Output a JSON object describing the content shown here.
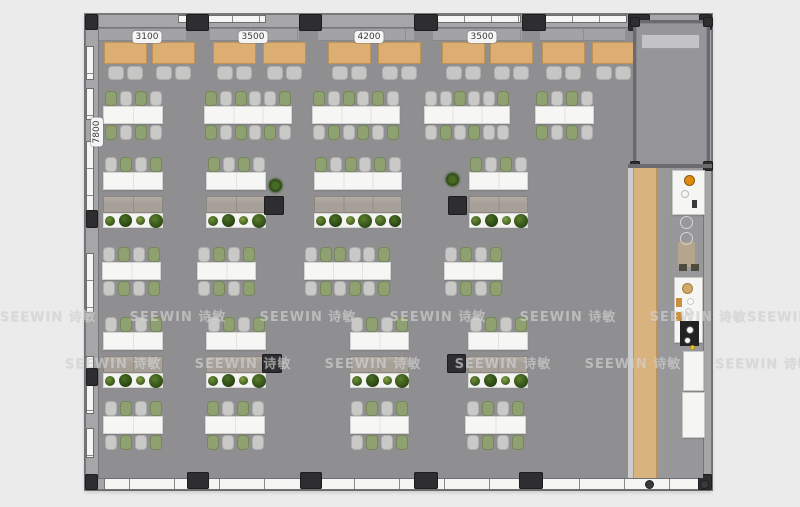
{
  "canvas": {
    "w": 800,
    "h": 507,
    "bg": "#ebebeb"
  },
  "watermark": {
    "text": "SEEWIN 诗敏",
    "rows": [
      {
        "y": 306,
        "xs": [
          48,
          178,
          308,
          438,
          568,
          698,
          795
        ]
      },
      {
        "y": 353,
        "xs": [
          113,
          243,
          373,
          503,
          633,
          763
        ]
      }
    ]
  },
  "labels": {
    "top_y": 17,
    "top": [
      {
        "text": "3100",
        "x": 62
      },
      {
        "text": "3500",
        "x": 168
      },
      {
        "text": "4200",
        "x": 284
      },
      {
        "text": "3500",
        "x": 397
      }
    ],
    "left": {
      "text": "7800",
      "x": 12,
      "y": 98
    }
  },
  "plan": {
    "x": 85,
    "y": 14,
    "w": 627,
    "h": 476,
    "colors": {
      "floor": "#8f8f91",
      "wall": "#a6a6a8",
      "pillar": "#2e2e30",
      "bench": "#a3a3a5",
      "booth_table": "#dcae72",
      "booth_chair": "#c6c6c4",
      "desk": "#f6f6f4",
      "chair_green": "#8fa170",
      "chair_silver": "#c9c9c7",
      "chair_green_border": "#76875a",
      "chair_silver_border": "#aeaeac",
      "cabinet": "#a7a099",
      "planter": "#f4f4f2",
      "wood": "#d9b37e",
      "room_floor": "#96969a",
      "credenza": "#c4c4c6",
      "kitchen_floor": "#98989b",
      "corridor_light": "#cdcdcf"
    },
    "walls": [
      {
        "side": "top",
        "x": 0,
        "y": 0,
        "w": 627,
        "h": 14
      },
      {
        "side": "left",
        "x": 0,
        "y": 0,
        "w": 14,
        "h": 476
      },
      {
        "side": "right",
        "x": 618,
        "y": 0,
        "w": 9,
        "h": 476
      }
    ],
    "bottom_band": {
      "x": 0,
      "y": 464,
      "w": 627,
      "h": 12
    },
    "bottom_cap": {
      "x": 0,
      "y": 464,
      "w": 20,
      "h": 12
    },
    "windows_top": [
      {
        "x": 93,
        "w": 88
      },
      {
        "x": 352,
        "w": 84
      },
      {
        "x": 460,
        "w": 82
      }
    ],
    "windows_left": [
      {
        "y": 32,
        "h": 34
      },
      {
        "y": 74,
        "h": 32
      },
      {
        "y": 127,
        "h": 72
      },
      {
        "y": 239,
        "h": 60
      },
      {
        "y": 342,
        "h": 58
      },
      {
        "y": 414,
        "h": 30
      }
    ],
    "pillars": [
      {
        "x": 101,
        "y": 0,
        "w": 23,
        "h": 17
      },
      {
        "x": 214,
        "y": 0,
        "w": 23,
        "h": 17
      },
      {
        "x": 329,
        "y": 0,
        "w": 24,
        "h": 17
      },
      {
        "x": 437,
        "y": 0,
        "w": 24,
        "h": 17
      },
      {
        "x": 543,
        "y": 0,
        "w": 22,
        "h": 17
      },
      {
        "x": 0,
        "y": 0,
        "w": 13,
        "h": 16
      },
      {
        "x": 614,
        "y": 0,
        "w": 13,
        "h": 16
      },
      {
        "x": 1,
        "y": 196,
        "w": 12,
        "h": 18
      },
      {
        "x": 1,
        "y": 354,
        "w": 12,
        "h": 18
      },
      {
        "x": 179,
        "y": 182,
        "w": 20,
        "h": 19
      },
      {
        "x": 363,
        "y": 182,
        "w": 19,
        "h": 19
      },
      {
        "x": 177,
        "y": 340,
        "w": 20,
        "h": 19
      },
      {
        "x": 362,
        "y": 340,
        "w": 19,
        "h": 19
      },
      {
        "x": 102,
        "y": 458,
        "w": 22,
        "h": 17
      },
      {
        "x": 215,
        "y": 458,
        "w": 22,
        "h": 17
      },
      {
        "x": 329,
        "y": 458,
        "w": 24,
        "h": 17
      },
      {
        "x": 434,
        "y": 458,
        "w": 24,
        "h": 17
      },
      {
        "x": 0,
        "y": 460,
        "w": 13,
        "h": 16
      },
      {
        "x": 613,
        "y": 460,
        "w": 14,
        "h": 16
      }
    ],
    "bench_y": 14,
    "bench_h": 13,
    "benches": [
      {
        "x": 14,
        "w": 87
      },
      {
        "x": 125,
        "w": 89
      },
      {
        "x": 233,
        "w": 96
      },
      {
        "x": 348,
        "w": 89
      },
      {
        "x": 455,
        "w": 85
      }
    ],
    "booth_tables": {
      "y": 28,
      "w": 43,
      "h": 22,
      "chair_y": 52,
      "xs": [
        19,
        67,
        128,
        178,
        243,
        293,
        357,
        405,
        457,
        507
      ]
    },
    "desk_h": 18,
    "chair_h": 15,
    "cab_h": 17,
    "planter_h": 15,
    "desk_rows": [
      {
        "chairs_top": 77,
        "desk": 92,
        "chairs_bottom": 111,
        "clusters": [
          {
            "x": 18,
            "w": 60,
            "segs": 2,
            "top": "gsgs",
            "bottom": "gsgs"
          },
          {
            "x": 119,
            "w": 88,
            "segs": 3,
            "top": "gsgssg",
            "bottom": "gsgsgs"
          },
          {
            "x": 227,
            "w": 88,
            "segs": 3,
            "top": "gsgsgs",
            "bottom": "sgsgsg"
          },
          {
            "x": 339,
            "w": 86,
            "segs": 3,
            "top": "ssgssg",
            "bottom": "sgsgss"
          },
          {
            "x": 450,
            "w": 59,
            "segs": 2,
            "top": "gsgs",
            "bottom": "gsgs"
          }
        ]
      },
      {
        "chairs_top": 143,
        "desk": 158,
        "cabinet": 182,
        "planter": 199,
        "clusters": [
          {
            "x": 18,
            "w": 60,
            "segs": 2,
            "top": "sgsg",
            "plants": 4
          },
          {
            "x": 121,
            "w": 60,
            "segs": 2,
            "top": "gsgs",
            "plants": 4
          },
          {
            "x": 229,
            "w": 88,
            "segs": 3,
            "top": "gsgsgs",
            "plants": 6
          },
          {
            "x": 384,
            "w": 59,
            "segs": 2,
            "top": "gsgs",
            "plants": 4
          }
        ]
      },
      {
        "chairs_top": 233,
        "desk": 248,
        "chairs_bottom": 267,
        "clusters": [
          {
            "x": 17,
            "w": 59,
            "segs": 2,
            "top": "sgsg",
            "bottom": "sgsg"
          },
          {
            "x": 112,
            "w": 59,
            "segs": 2,
            "top": "sgsg",
            "bottom": "sgsg"
          },
          {
            "x": 219,
            "w": 87,
            "segs": 3,
            "top": "sggssg",
            "bottom": "sgsgsg"
          },
          {
            "x": 359,
            "w": 59,
            "segs": 2,
            "top": "sgsg",
            "bottom": "sgsg"
          }
        ]
      },
      {
        "chairs_top": 303,
        "desk": 318,
        "cabinet": 342,
        "planter": 359,
        "clusters": [
          {
            "x": 18,
            "w": 60,
            "segs": 2,
            "top": "sgsg",
            "plants": 4
          },
          {
            "x": 121,
            "w": 60,
            "segs": 2,
            "top": "sgsg",
            "plants": 4
          },
          {
            "x": 265,
            "w": 59,
            "segs": 2,
            "top": "sgsg",
            "plants": 4
          },
          {
            "x": 383,
            "w": 60,
            "segs": 2,
            "top": "sgsg",
            "plants": 4
          }
        ]
      },
      {
        "chairs_top": 387,
        "desk": 402,
        "chairs_bottom": 421,
        "clusters": [
          {
            "x": 18,
            "w": 60,
            "segs": 2,
            "top": "sgsg",
            "bottom": "sgsg"
          },
          {
            "x": 120,
            "w": 60,
            "segs": 2,
            "top": "gsgs",
            "bottom": "gsgs"
          },
          {
            "x": 265,
            "w": 59,
            "segs": 2,
            "top": "sgsg",
            "bottom": "sgsg"
          },
          {
            "x": 380,
            "w": 61,
            "segs": 2,
            "top": "sgsg",
            "bottom": "sgsg"
          }
        ]
      }
    ],
    "plant_palette": [
      [
        "#6f8f38",
        "#33511a"
      ],
      [
        "#4c7026",
        "#243f10"
      ],
      [
        "#86a347",
        "#3c5a1e"
      ],
      [
        "#5a7e2c",
        "#2b4814"
      ]
    ],
    "plant_sizes": [
      10,
      13,
      9,
      14,
      11,
      12
    ],
    "floor_plants": [
      {
        "x": 181,
        "y": 162,
        "s": 19
      },
      {
        "x": 358,
        "y": 156,
        "s": 19
      }
    ],
    "meeting_room": {
      "x": 548,
      "y": 6,
      "w": 77,
      "h": 148,
      "credenza": {
        "x": 8,
        "y": 14,
        "w": 59,
        "h": 15
      }
    },
    "corridor": {
      "divider": {
        "x": 543,
        "y": 150,
        "w": 84,
        "h": 4
      },
      "light": {
        "x": 543,
        "y": 154,
        "w": 5,
        "h": 310
      },
      "wood": {
        "x": 548,
        "y": 154,
        "w": 24,
        "h": 310
      },
      "kitchen_floor": {
        "x": 572,
        "y": 154,
        "w": 46,
        "h": 310
      }
    },
    "kitchen": {
      "panels": [
        {
          "x": 587,
          "y": 156,
          "w": 33,
          "h": 45
        },
        {
          "x": 589,
          "y": 263,
          "w": 29,
          "h": 66
        },
        {
          "x": 598,
          "y": 337,
          "w": 21,
          "h": 40
        },
        {
          "x": 597,
          "y": 378,
          "w": 23,
          "h": 46
        }
      ],
      "rects": [
        {
          "x": 595,
          "y": 307,
          "w": 19,
          "h": 25,
          "c": "#222224"
        },
        {
          "x": 591,
          "y": 284,
          "w": 6,
          "h": 9,
          "c": "#c9913f"
        },
        {
          "x": 591,
          "y": 298,
          "w": 6,
          "h": 9,
          "c": "#c9913f"
        },
        {
          "x": 593,
          "y": 228,
          "w": 17,
          "h": 25,
          "c": "#b4a68c"
        },
        {
          "x": 607,
          "y": 186,
          "w": 5,
          "h": 8,
          "c": "#3a3a3c"
        },
        {
          "x": 594,
          "y": 250,
          "w": 8,
          "h": 7,
          "c": "#4c4c3e"
        },
        {
          "x": 606,
          "y": 250,
          "w": 8,
          "h": 7,
          "c": "#4c4c3e"
        }
      ],
      "circles": [
        {
          "x": 599,
          "y": 161,
          "d": 11,
          "c": "#e08a12",
          "b": "#8a5a0a"
        },
        {
          "x": 596,
          "y": 176,
          "d": 8,
          "c": "transparent",
          "b": "#b9b9b7"
        },
        {
          "x": 597,
          "y": 269,
          "d": 11,
          "c": "#d2a968",
          "b": "#a37c3f"
        },
        {
          "x": 602,
          "y": 284,
          "d": 7,
          "c": "#fafafa",
          "b": "#c9c9c9"
        },
        {
          "x": 600,
          "y": 294,
          "d": 7,
          "c": "#f0f0ee",
          "b": "#c9c9c9"
        },
        {
          "x": 601,
          "y": 312,
          "d": 8,
          "c": "#fafafa",
          "b": "#555557"
        },
        {
          "x": 599,
          "y": 323,
          "d": 7,
          "c": "#fafafa",
          "b": "#555557"
        },
        {
          "x": 605,
          "y": 331,
          "d": 5,
          "c": "#e6c43c",
          "b": "#b99112"
        },
        {
          "x": 595,
          "y": 202,
          "d": 13,
          "c": "transparent",
          "b": "#d5d5d3"
        },
        {
          "x": 595,
          "y": 218,
          "d": 13,
          "c": "transparent",
          "b": "#d5d5d3"
        },
        {
          "x": 560,
          "y": 466,
          "d": 9,
          "c": "#3a3a3c",
          "b": "#222224"
        },
        {
          "x": 615,
          "y": 466,
          "d": 9,
          "c": "#3a3a3c",
          "b": "#222224"
        }
      ]
    }
  }
}
